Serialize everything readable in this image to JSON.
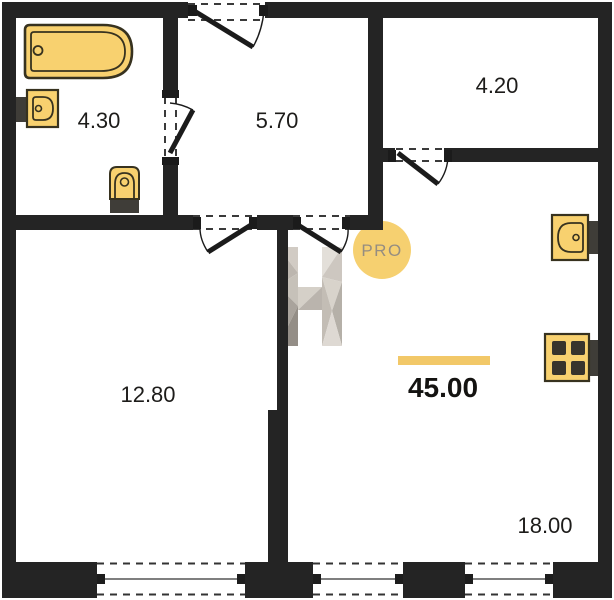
{
  "plan_type": "apartment-floor-plan",
  "badge": {
    "label": "PRO",
    "fill": "#F6CE6B",
    "text_color": "#958D81"
  },
  "watermark": {
    "letter": "H"
  },
  "total": {
    "area": "45.00",
    "accent_bar_color": "#F2C868"
  },
  "rooms": [
    {
      "id": "bathroom",
      "area": "4.30"
    },
    {
      "id": "hallway",
      "area": "5.70"
    },
    {
      "id": "top-right-room",
      "area": "4.20"
    },
    {
      "id": "bottom-left-room",
      "area": "12.80"
    },
    {
      "id": "bottom-right-room",
      "area": "18.00"
    }
  ],
  "fixtures": [
    {
      "icon": "bathtub-icon"
    },
    {
      "icon": "washbasin-icon"
    },
    {
      "icon": "toilet-icon"
    },
    {
      "icon": "kitchen-sink-icon"
    },
    {
      "icon": "stove-icon"
    }
  ],
  "colors": {
    "wall": "#242424",
    "fixture_fill": "#F8D16F",
    "fixture_stroke": "#37321F",
    "line": "#2c2c2c",
    "background": "#ffffff"
  }
}
